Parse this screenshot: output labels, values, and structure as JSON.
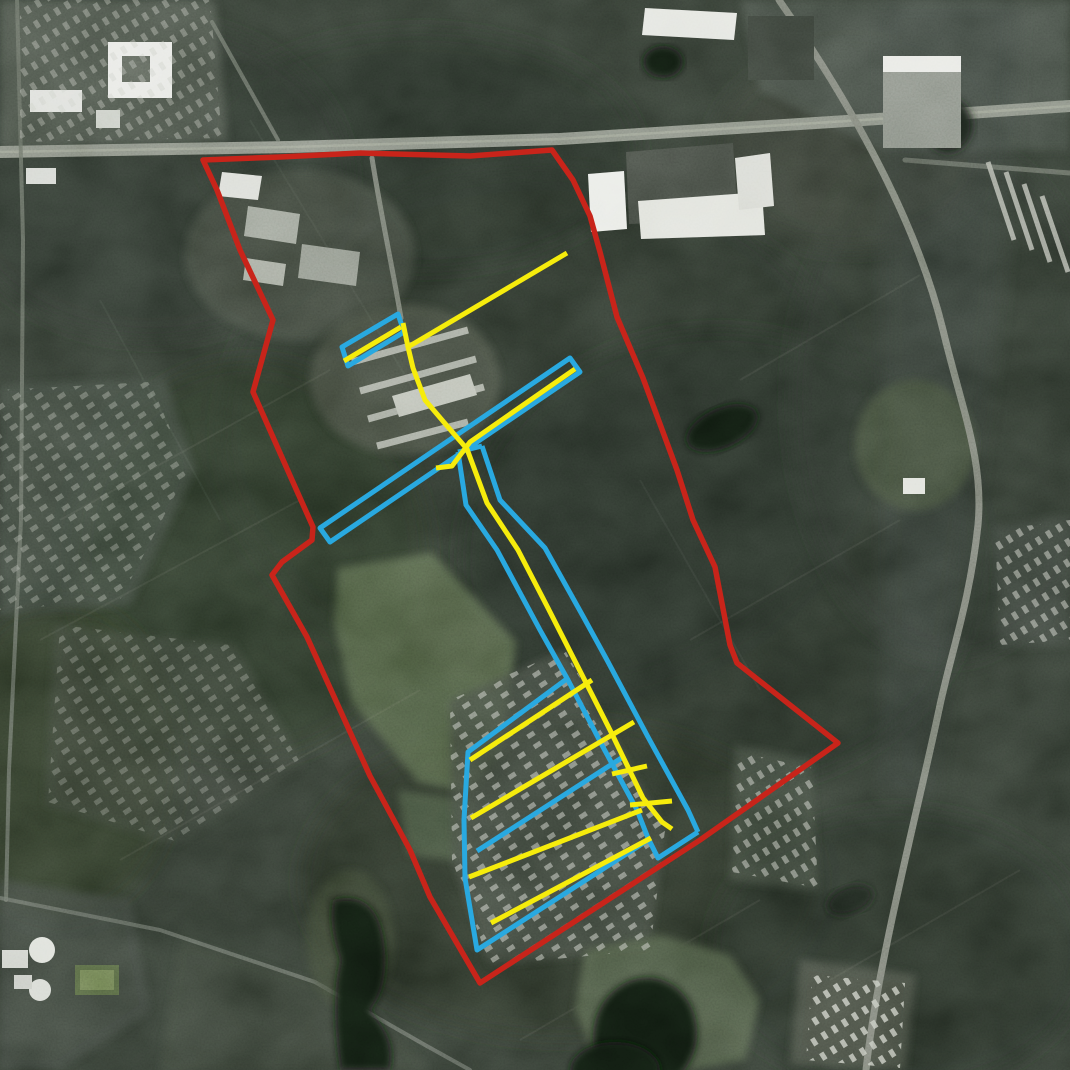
{
  "meta": {
    "type": "annotated-aerial-satellite-map",
    "width": 1070,
    "height": 1070,
    "visible_text": "none"
  },
  "map": {
    "legend_colors": {
      "site_boundary": "#c8241a",
      "corridor_outlines": "#29a9e0",
      "street_lines": "#f6ec0c"
    },
    "overlays": {
      "layers": [
        {
          "name": "blue-corridor-overlays",
          "color": "#29a9e0",
          "width": 5,
          "shapes": [
            {
              "name": "nw-parallelogram",
              "closed": true,
              "points": [
                [
                  342,
                  347
                ],
                [
                  398,
                  314
                ],
                [
                  404,
                  332
                ],
                [
                  348,
                  366
                ]
              ]
            },
            {
              "name": "central-diagonal-band",
              "closed": true,
              "points": [
                [
                  570,
                  358
                ],
                [
                  580,
                  372
                ],
                [
                  330,
                  542
                ],
                [
                  320,
                  528
                ]
              ]
            },
            {
              "name": "corridor-west-edge",
              "closed": false,
              "points": [
                [
                  458,
                  452
                ],
                [
                  466,
                  505
                ],
                [
                  497,
                  550
                ],
                [
                  540,
                  630
                ],
                [
                  568,
                  680
                ],
                [
                  603,
                  747
                ],
                [
                  637,
                  810
                ],
                [
                  648,
                  838
                ],
                [
                  658,
                  858
                ],
                [
                  698,
                  832
                ]
              ]
            },
            {
              "name": "corridor-east-edge",
              "closed": false,
              "points": [
                [
                  482,
                  446
                ],
                [
                  500,
                  500
                ],
                [
                  545,
                  548
                ],
                [
                  584,
                  618
                ],
                [
                  607,
                  660
                ],
                [
                  648,
                  737
                ],
                [
                  688,
                  810
                ],
                [
                  698,
                  832
                ]
              ]
            },
            {
              "name": "corridor-north-cap",
              "closed": false,
              "points": [
                [
                  458,
                  452
                ],
                [
                  482,
                  446
                ]
              ]
            },
            {
              "name": "south-park-outline",
              "closed": false,
              "points": [
                [
                  568,
                  678
                ],
                [
                  468,
                  752
                ],
                [
                  464,
                  820
                ],
                [
                  465,
                  878
                ],
                [
                  477,
                  950
                ],
                [
                  648,
                  840
                ]
              ]
            },
            {
              "name": "south-park-inner-line",
              "closed": false,
              "points": [
                [
                  477,
                  851
                ],
                [
                  623,
                  757
                ]
              ]
            }
          ]
        },
        {
          "name": "yellow-line-overlays",
          "color": "#f6ec0c",
          "width": 5,
          "shapes": [
            {
              "name": "northeast-diagonal",
              "closed": false,
              "points": [
                [
                  567,
                  253
                ],
                [
                  408,
                  347
                ]
              ]
            },
            {
              "name": "main-street-line",
              "closed": false,
              "points": [
                [
                  403,
                  323
                ],
                [
                  408,
                  347
                ],
                [
                  413,
                  368
                ],
                [
                  425,
                  400
                ],
                [
                  448,
                  427
                ],
                [
                  467,
                  449
                ],
                [
                  487,
                  503
                ],
                [
                  518,
                  550
                ],
                [
                  548,
                  608
                ],
                [
                  578,
                  667
                ],
                [
                  610,
                  730
                ],
                [
                  643,
                  798
                ],
                [
                  662,
                  822
                ],
                [
                  672,
                  829
                ]
              ]
            },
            {
              "name": "parallelogram-line",
              "closed": false,
              "points": [
                [
                  344,
                  361
                ],
                [
                  401,
                  327
                ]
              ]
            },
            {
              "name": "band-line",
              "closed": false,
              "points": [
                [
                  575,
                  369
                ],
                [
                  470,
                  442
                ],
                [
                  452,
                  466
                ],
                [
                  436,
                  468
                ]
              ]
            },
            {
              "name": "park-stripe-1",
              "closed": false,
              "points": [
                [
                  470,
                  760
                ],
                [
                  592,
                  680
                ]
              ]
            },
            {
              "name": "park-stripe-2",
              "closed": false,
              "points": [
                [
                  471,
                  818
                ],
                [
                  634,
                  722
                ]
              ]
            },
            {
              "name": "park-stripe-3",
              "closed": false,
              "points": [
                [
                  469,
                  877
                ],
                [
                  642,
                  810
                ]
              ]
            },
            {
              "name": "park-stripe-4",
              "closed": false,
              "points": [
                [
                  491,
                  923
                ],
                [
                  651,
                  838
                ]
              ]
            },
            {
              "name": "corridor-rung-1",
              "closed": false,
              "points": [
                [
                  612,
                  774
                ],
                [
                  647,
                  766
                ]
              ]
            },
            {
              "name": "corridor-rung-2",
              "closed": false,
              "points": [
                [
                  630,
                  805
                ],
                [
                  672,
                  801
                ]
              ]
            }
          ]
        },
        {
          "name": "boundary-overlay",
          "color": "#c8241a",
          "width": 5.5,
          "shapes": [
            {
              "name": "site-boundary",
              "closed": true,
              "points": [
                [
                  203,
                  160
                ],
                [
                  280,
                  157
                ],
                [
                  360,
                  153
                ],
                [
                  470,
                  156
                ],
                [
                  552,
                  150
                ],
                [
                  573,
                  180
                ],
                [
                  590,
                  216
                ],
                [
                  600,
                  252
                ],
                [
                  617,
                  317
                ],
                [
                  643,
                  378
                ],
                [
                  677,
                  470
                ],
                [
                  693,
                  520
                ],
                [
                  715,
                  567
                ],
                [
                  730,
                  645
                ],
                [
                  737,
                  663
                ],
                [
                  838,
                  743
                ],
                [
                  700,
                  840
                ],
                [
                  480,
                  983
                ],
                [
                  430,
                  897
                ],
                [
                  410,
                  850
                ],
                [
                  370,
                  776
                ],
                [
                  307,
                  637
                ],
                [
                  272,
                  575
                ],
                [
                  282,
                  562
                ],
                [
                  312,
                  540
                ],
                [
                  313,
                  527
                ],
                [
                  292,
                  480
                ],
                [
                  253,
                  392
                ],
                [
                  273,
                  320
                ],
                [
                  240,
                  250
                ],
                [
                  217,
                  190
                ]
              ]
            }
          ]
        }
      ]
    }
  }
}
